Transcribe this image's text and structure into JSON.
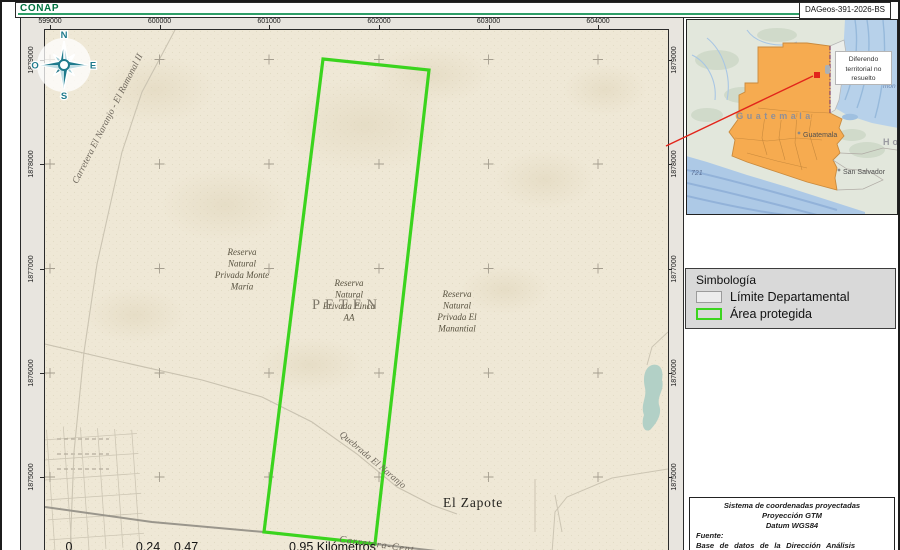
{
  "header": {
    "logo": "CONAP",
    "doc_id": "DAGeos-391-2026-BS"
  },
  "map": {
    "x_ticks": [
      "599000",
      "600000",
      "601000",
      "602000",
      "603000",
      "604000"
    ],
    "y_ticks": [
      "1879000",
      "1878000",
      "1877000",
      "1876000",
      "1875000"
    ],
    "compass": {
      "n": "N",
      "e": "E",
      "s": "S",
      "w": "O"
    },
    "labels": {
      "reserva_monte_maria": [
        "Reserva",
        "Natural",
        "Privada Monte",
        "María"
      ],
      "reserva_finca_aa": [
        "Reserva",
        "Natural",
        "Privada Finca",
        "AA"
      ],
      "reserva_el_manantial": [
        "Reserva",
        "Natural",
        "Privada El",
        "Manantial"
      ],
      "department": "PETÉN",
      "town": "El Zapote",
      "stream": "Quebrada El Naranjo",
      "road_nw": "Carretera El Naranjo - El Ramonal II",
      "road_s": "Carretera-Cent"
    },
    "scale": {
      "t0": "0",
      "t1": "0.24",
      "t2": "0.47",
      "t3": "0.95 Kilómetros"
    }
  },
  "inset": {
    "country": "Guatemala",
    "city": "Guatemala",
    "city2": "San Salvador",
    "neighbor_fragment": "Ho",
    "sea_fragment": "mon",
    "depth_label": "721",
    "callout_line1": "Diferendo",
    "callout_line2": "territorial no",
    "callout_line3": "resuelto"
  },
  "legend": {
    "title": "Simbología",
    "items": [
      {
        "label": "Límite Departamental",
        "fill": "#ececec",
        "border": "#9b9b9b"
      },
      {
        "label": "Área protegida",
        "fill": "transparent",
        "border": "#3bd41e"
      }
    ]
  },
  "source_box": {
    "line1": "Sistema de coordenadas proyectadas",
    "line2": "Proyección GTM",
    "line3": "Datum WGS84",
    "line4": "Fuente:",
    "line5": "Base de datos de la Dirección Análisis Geoespacial"
  },
  "colors": {
    "protected_area_green": "#3bd41e",
    "leader_red": "#e2251b",
    "highlight_orange": "#f6ab50",
    "compass_teal": "#1f7a8c",
    "conap_green": "#00713f",
    "map_paper": "#efe8d6"
  }
}
